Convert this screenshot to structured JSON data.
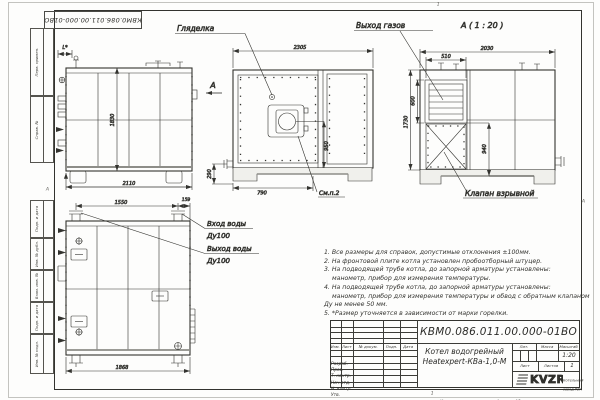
{
  "sheet": {
    "stamp_number": "КВМ0.086.011.00.000-01ВО",
    "margin_cells": [
      "Перв. примен.",
      "Справ. №",
      "Подп. и дата",
      "Инв. № дубл.",
      "Взам. инв. №",
      "Подп. и дата",
      "Инв. № подл."
    ],
    "fold_marks": {
      "top": "1",
      "bottom": "1",
      "left": "А",
      "right": "А"
    }
  },
  "views": {
    "side": {
      "dim_l": "L*",
      "dim_height": "1830",
      "dim_width": "2110",
      "view_arrow_label": "А"
    },
    "front": {
      "label_sight_glass": "Гляделка",
      "dim_top": "2305",
      "dim_axis": "950",
      "dim_bottom": "790",
      "dim_foot": "290",
      "label_see_item": "См.п.2"
    },
    "rear": {
      "view_title": "А ( 1 : 20 )",
      "label_gas_outlet": "Выход газов",
      "label_explosion_valve": "Клапан взрывной",
      "dim_top": "2030",
      "dim_louver_width": "510",
      "dim_louver_height": "600",
      "dim_height": "1730",
      "dim_lower": "940"
    },
    "top": {
      "dim_pipe_spacing": "1550",
      "dim_edge": "159",
      "dim_width": "1868",
      "label_water_in": "Вход воды",
      "label_water_in_dn": "Ду100",
      "label_water_out": "Выход воды",
      "label_water_out_dn": "Ду100"
    }
  },
  "notes": {
    "lines": [
      "1. Все размеры для справок, допустимые отклонения ±100мм.",
      "2. На фронтовой плите котла установлен пробоотборный штуцер.",
      "3. На подводящей трубе котла, до запорной арматуры установлены:",
      "манометр, прибор для измерения температуры.",
      "4. На подводящей трубе котла, до запорной арматуры установлены:",
      "манометр, прибор для измерения температуры и обвод с обратным клапаном",
      "Ду не менее 50 мм.",
      "5. *Размер уточняется в зависимости от марки горелки."
    ]
  },
  "title_block": {
    "doc_number": "КВМ0.086.011.00.000-01ВО",
    "product_name_line1": "Котел водогрейный",
    "product_name_line2": "Heatexpert-КВа-1,0-М",
    "col_izm": "Изм.",
    "col_list": "Лист",
    "col_doc": "№ докум.",
    "col_podp": "Подп.",
    "col_data": "Дата",
    "row_labels": [
      "Разраб.",
      "Пров.",
      "Т. контр.",
      "Нач.отд.",
      "Н. контр.",
      "Утв."
    ],
    "lit_label": "Лит.",
    "mass_label": "Масса",
    "scale_label": "Масштаб",
    "scale_value": "1:20",
    "sheet_label": "Лист",
    "sheets_label": "Листов",
    "sheets_value": "1",
    "logo_text": "KVZR",
    "company_line1": "Котельный",
    "company_line2": "завод РЭП",
    "copied_label": "Копировал",
    "format_label": "Формат А3"
  }
}
